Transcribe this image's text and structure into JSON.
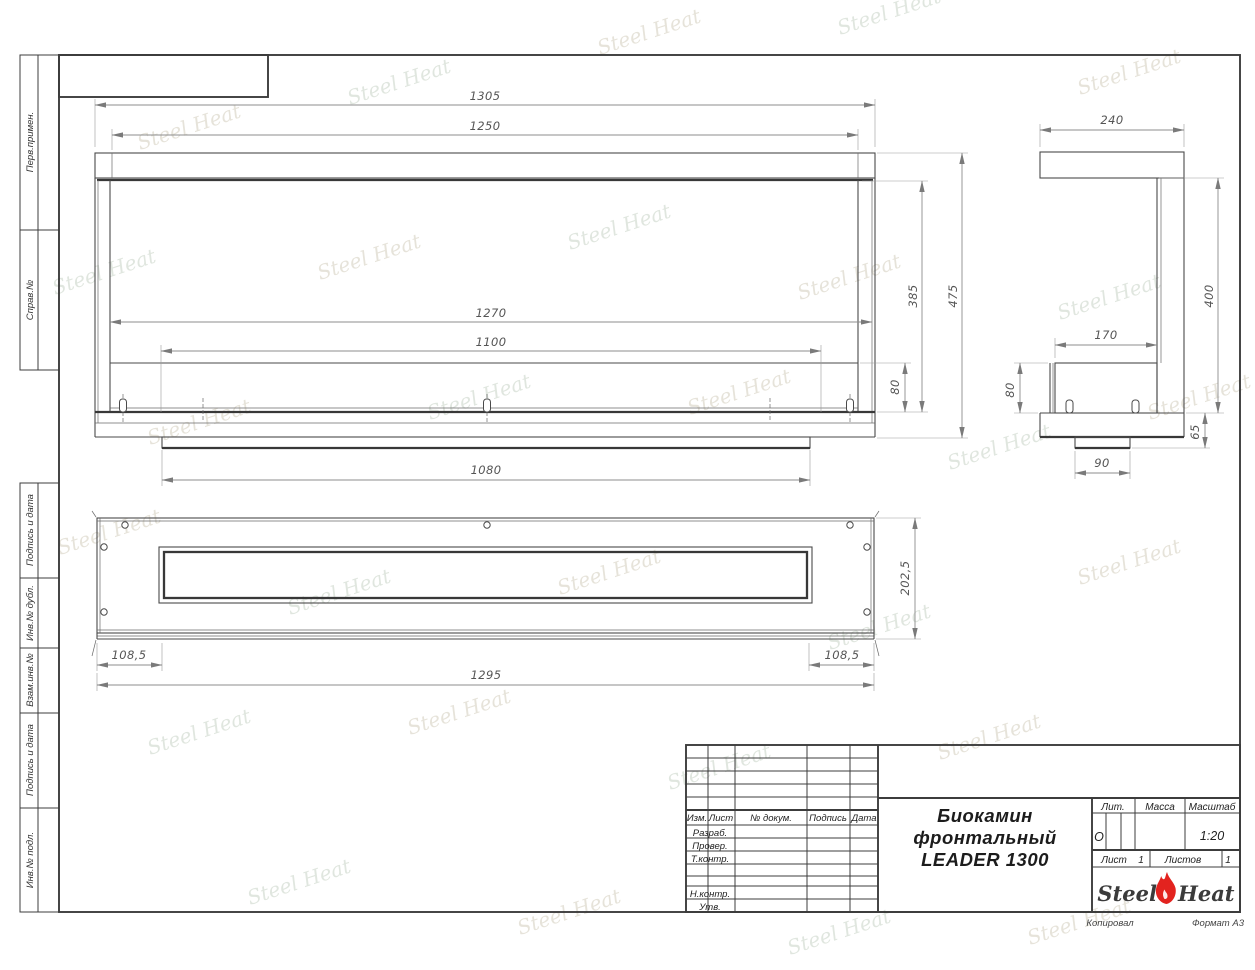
{
  "watermark": {
    "text": "Steel Heat"
  },
  "frame_labels": {
    "perv": "Перв.примен.",
    "sprav": "Справ.№",
    "podpis1": "Подпись и дата",
    "inv_dubl": "Инв.№ дубл.",
    "vzam": "Взам.инв.№",
    "podpis2": "Подпись и дата",
    "inv_podl": "Инв.№ подл."
  },
  "stamp": {
    "header_cols": {
      "izm": "Изм.",
      "list": "Лист",
      "doc": "№ докум.",
      "sign": "Подпись",
      "date": "Дата"
    },
    "rows": {
      "razrab": "Разраб.",
      "prover": "Провер.",
      "tkontr": "Т.контр.",
      "nkontr": "Н.контр.",
      "utv": "Утв."
    },
    "title_line1": "Биокамин",
    "title_line2": "фронтальный",
    "title_line3": "LEADER 1300",
    "lit_label": "Лит.",
    "lit_value": "О",
    "massa_label": "Масса",
    "masshtab_label": "Масштаб",
    "masshtab_value": "1:20",
    "list_label": "Лист",
    "list_value": "1",
    "listov_label": "Листов",
    "listov_value": "1",
    "logo_steel": "Steel",
    "logo_heat": "Heat",
    "kopiroval": "Копировал",
    "format": "Формат А3"
  },
  "dims": {
    "front": {
      "d1305": "1305",
      "d1250": "1250",
      "d1270": "1270",
      "d1100": "1100",
      "d385": "385",
      "d475": "475",
      "d80": "80",
      "d1080": "1080"
    },
    "side": {
      "d240": "240",
      "d400": "400",
      "d170": "170",
      "d80": "80",
      "d65": "65",
      "d90": "90"
    },
    "plan": {
      "d202": "202,5",
      "d108l": "108,5",
      "d108r": "108,5",
      "d1295": "1295"
    }
  }
}
